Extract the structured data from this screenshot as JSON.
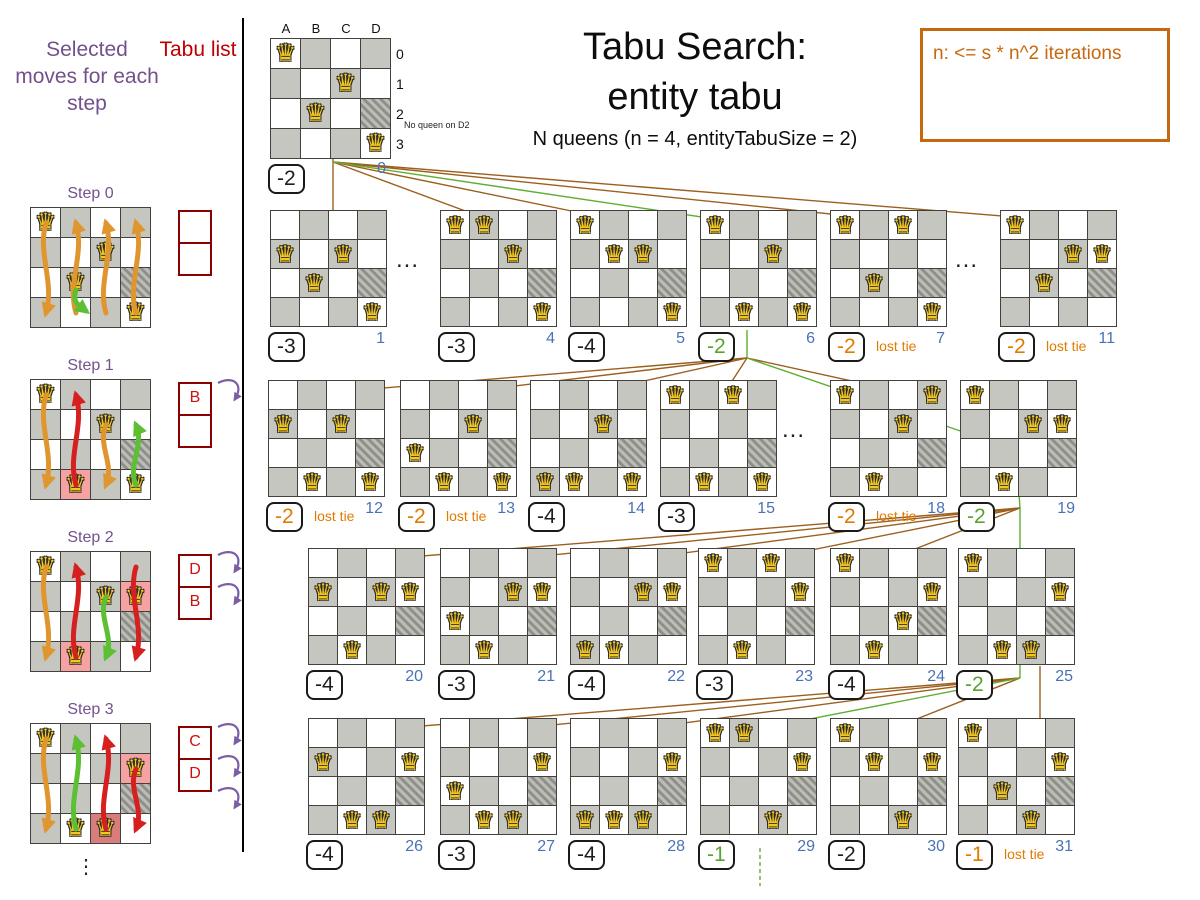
{
  "header": {
    "title_line1": "Tabu Search:",
    "title_line2": "entity tabu",
    "subtitle": "N queens (n = 4, entityTabuSize = 2)",
    "note": "n: <= s * n^2 iterations"
  },
  "left_panel": {
    "moves_title": "Selected moves for each step",
    "tabu_title": "Tabu list",
    "ellipsis": "⋮",
    "steps": [
      {
        "label": "Step 0",
        "queens": {
          "A": 0,
          "B": 2,
          "C": 1,
          "D": 3
        },
        "highlights": [],
        "tabu": [
          "",
          ""
        ],
        "curls": 0,
        "arrows": [
          {
            "col": 0,
            "from": 0,
            "to": 3,
            "color": "orange"
          },
          {
            "col": 1,
            "from": 3,
            "to": 0,
            "color": "orange"
          },
          {
            "col": 2,
            "from": 3,
            "to": 0,
            "color": "orange"
          },
          {
            "col": 3,
            "from": 3,
            "to": 0,
            "color": "orange"
          },
          {
            "col": 1,
            "from": 2,
            "to": 3,
            "color": "green",
            "small": true
          }
        ]
      },
      {
        "label": "Step 1",
        "queens": {
          "A": 0,
          "B": 3,
          "C": 1,
          "D": 3
        },
        "highlights": [
          "B3"
        ],
        "tabu": [
          "B",
          ""
        ],
        "curls": 1,
        "arrows": [
          {
            "col": 0,
            "from": 0,
            "to": 3,
            "color": "orange"
          },
          {
            "col": 1,
            "from": 3,
            "to": 0,
            "color": "red"
          },
          {
            "col": 2,
            "from": 1,
            "to": 3,
            "color": "orange"
          },
          {
            "col": 3,
            "from": 3,
            "to": 1,
            "color": "green"
          }
        ]
      },
      {
        "label": "Step 2",
        "queens": {
          "A": 0,
          "B": 3,
          "C": 1,
          "D": 1
        },
        "highlights": [
          "B3",
          "D1"
        ],
        "tabu": [
          "D",
          "B"
        ],
        "curls": 2,
        "arrows": [
          {
            "col": 0,
            "from": 0,
            "to": 3,
            "color": "orange"
          },
          {
            "col": 1,
            "from": 3,
            "to": 0,
            "color": "red"
          },
          {
            "col": 2,
            "from": 1,
            "to": 3,
            "color": "green"
          },
          {
            "col": 3,
            "from": 0,
            "to": 3,
            "color": "red"
          }
        ]
      },
      {
        "label": "Step 3",
        "queens": {
          "A": 0,
          "B": 3,
          "C": 3,
          "D": 1
        },
        "highlights": [
          "D1",
          "C3"
        ],
        "tabu": [
          "C",
          "D"
        ],
        "curls": 3,
        "arrows": [
          {
            "col": 0,
            "from": 0,
            "to": 3,
            "color": "orange"
          },
          {
            "col": 1,
            "from": 3,
            "to": 0,
            "color": "green"
          },
          {
            "col": 2,
            "from": 3,
            "to": 0,
            "color": "red"
          },
          {
            "col": 3,
            "from": 1,
            "to": 3,
            "color": "red"
          }
        ]
      }
    ]
  },
  "root_board": {
    "col_labels": [
      "A",
      "B",
      "C",
      "D"
    ],
    "row_labels": [
      "0",
      "1",
      "2",
      "3"
    ],
    "queens": {
      "A": 0,
      "B": 2,
      "C": 1,
      "D": 3
    },
    "annotation": "No queen on D2",
    "score": "-2",
    "score_color": "black",
    "index": "0"
  },
  "lost_tie_label": "lost tie",
  "row_ellipsis": "...",
  "rows": [
    {
      "boards": [
        {
          "queens": {
            "A": 1,
            "B": 2,
            "C": 1,
            "D": 3
          },
          "score": "-3",
          "score_color": "black",
          "index": "1"
        },
        {
          "queens": {
            "A": 0,
            "B": 0,
            "C": 1,
            "D": 3
          },
          "score": "-3",
          "score_color": "black",
          "index": "4"
        },
        {
          "queens": {
            "A": 0,
            "B": 1,
            "C": 1,
            "D": 3
          },
          "score": "-4",
          "score_color": "black",
          "index": "5"
        },
        {
          "queens": {
            "A": 0,
            "B": 3,
            "C": 1,
            "D": 3
          },
          "score": "-2",
          "score_color": "green",
          "index": "6"
        },
        {
          "queens": {
            "A": 0,
            "B": 2,
            "C": 0,
            "D": 3
          },
          "score": "-2",
          "score_color": "orange",
          "index": "7",
          "lost_tie": true
        },
        {
          "queens": {
            "A": 0,
            "B": 2,
            "C": 1,
            "D": 1
          },
          "score": "-2",
          "score_color": "orange",
          "index": "11",
          "lost_tie": true
        }
      ]
    },
    {
      "boards": [
        {
          "queens": {
            "A": 1,
            "B": 3,
            "C": 1,
            "D": 3
          },
          "score": "-2",
          "score_color": "orange",
          "index": "12",
          "lost_tie": true
        },
        {
          "queens": {
            "A": 2,
            "B": 3,
            "C": 1,
            "D": 3
          },
          "score": "-2",
          "score_color": "orange",
          "index": "13",
          "lost_tie": true
        },
        {
          "queens": {
            "A": 3,
            "B": 3,
            "C": 1,
            "D": 3
          },
          "score": "-4",
          "score_color": "black",
          "index": "14"
        },
        {
          "queens": {
            "A": 0,
            "B": 3,
            "C": 0,
            "D": 3
          },
          "score": "-3",
          "score_color": "black",
          "index": "15"
        },
        {
          "queens": {
            "A": 0,
            "B": 3,
            "C": 1,
            "D": 0
          },
          "score": "-2",
          "score_color": "orange",
          "index": "18",
          "lost_tie": true
        },
        {
          "queens": {
            "A": 0,
            "B": 3,
            "C": 1,
            "D": 1
          },
          "score": "-2",
          "score_color": "green",
          "index": "19"
        }
      ]
    },
    {
      "boards": [
        {
          "queens": {
            "A": 1,
            "B": 3,
            "C": 1,
            "D": 1
          },
          "score": "-4",
          "score_color": "black",
          "index": "20"
        },
        {
          "queens": {
            "A": 2,
            "B": 3,
            "C": 1,
            "D": 1
          },
          "score": "-3",
          "score_color": "black",
          "index": "21"
        },
        {
          "queens": {
            "A": 3,
            "B": 3,
            "C": 1,
            "D": 1
          },
          "score": "-4",
          "score_color": "black",
          "index": "22"
        },
        {
          "queens": {
            "A": 0,
            "B": 3,
            "C": 0,
            "D": 1
          },
          "score": "-3",
          "score_color": "black",
          "index": "23"
        },
        {
          "queens": {
            "A": 0,
            "B": 3,
            "C": 2,
            "D": 1
          },
          "score": "-4",
          "score_color": "black",
          "index": "24"
        },
        {
          "queens": {
            "A": 0,
            "B": 3,
            "C": 3,
            "D": 1
          },
          "score": "-2",
          "score_color": "green",
          "index": "25"
        }
      ]
    },
    {
      "boards": [
        {
          "queens": {
            "A": 1,
            "B": 3,
            "C": 3,
            "D": 1
          },
          "score": "-4",
          "score_color": "black",
          "index": "26"
        },
        {
          "queens": {
            "A": 2,
            "B": 3,
            "C": 3,
            "D": 1
          },
          "score": "-3",
          "score_color": "black",
          "index": "27"
        },
        {
          "queens": {
            "A": 3,
            "B": 3,
            "C": 3,
            "D": 1
          },
          "score": "-4",
          "score_color": "black",
          "index": "28"
        },
        {
          "queens": {
            "A": 0,
            "B": 0,
            "C": 3,
            "D": 1
          },
          "score": "-1",
          "score_color": "green",
          "index": "29"
        },
        {
          "queens": {
            "A": 0,
            "B": 1,
            "C": 3,
            "D": 1
          },
          "score": "-2",
          "score_color": "black",
          "index": "30"
        },
        {
          "queens": {
            "A": 0,
            "B": 2,
            "C": 3,
            "D": 1
          },
          "score": "-1",
          "score_color": "orange",
          "index": "31",
          "lost_tie": true
        }
      ]
    }
  ],
  "colors": {
    "purple": "#73518e",
    "tabu_red": "#c00000",
    "orange_note": "#c8680e",
    "score_green": "#58a22e",
    "score_orange": "#e07b00",
    "index_blue": "#4a72b8",
    "line_brown": "#9c5f1e",
    "line_green": "#5fae33",
    "arrow_orange": "#e0962f",
    "arrow_red": "#d62020",
    "arrow_green": "#5cc032"
  }
}
